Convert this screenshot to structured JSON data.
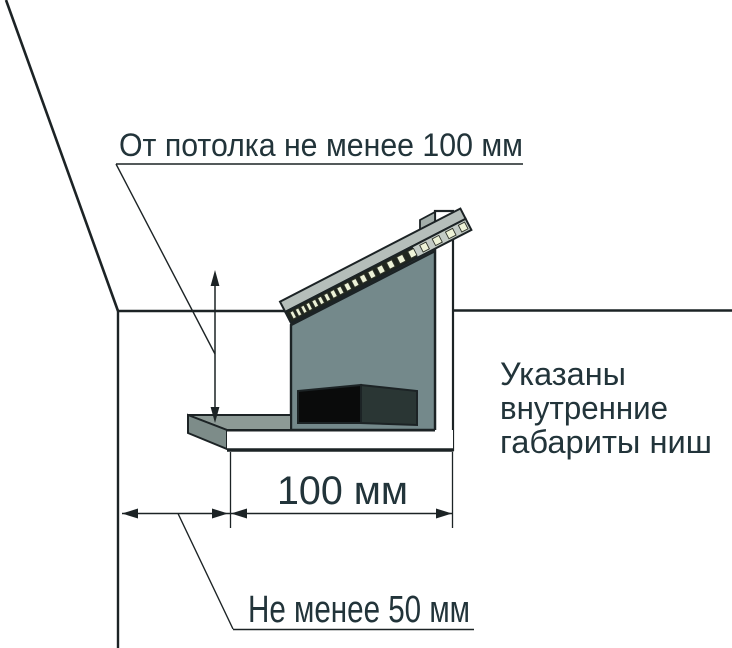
{
  "annotations": {
    "ceiling_note": "От потолка не менее 100 мм",
    "width_dimension": "100 мм",
    "wall_offset_note": "Не менее 50 мм",
    "side_note": [
      "Указаны",
      "внутренние",
      "габариты ниш"
    ]
  },
  "colors": {
    "line": "#1c2325",
    "text": "#22343a",
    "back_panel": "#74898b",
    "shelf_top": "#8d9a96",
    "shelf_bevel": "#7d8c89",
    "strip_top": "#b5beba",
    "led_band_dark": "#20261f",
    "led_band_light": "#c3cbc5",
    "led_chip": "#edf2d7",
    "box_front": "#0a0b0b",
    "box_side": "#2a3634",
    "top_cap": "#a3aeaa",
    "niche_inner": "#ffffff"
  }
}
